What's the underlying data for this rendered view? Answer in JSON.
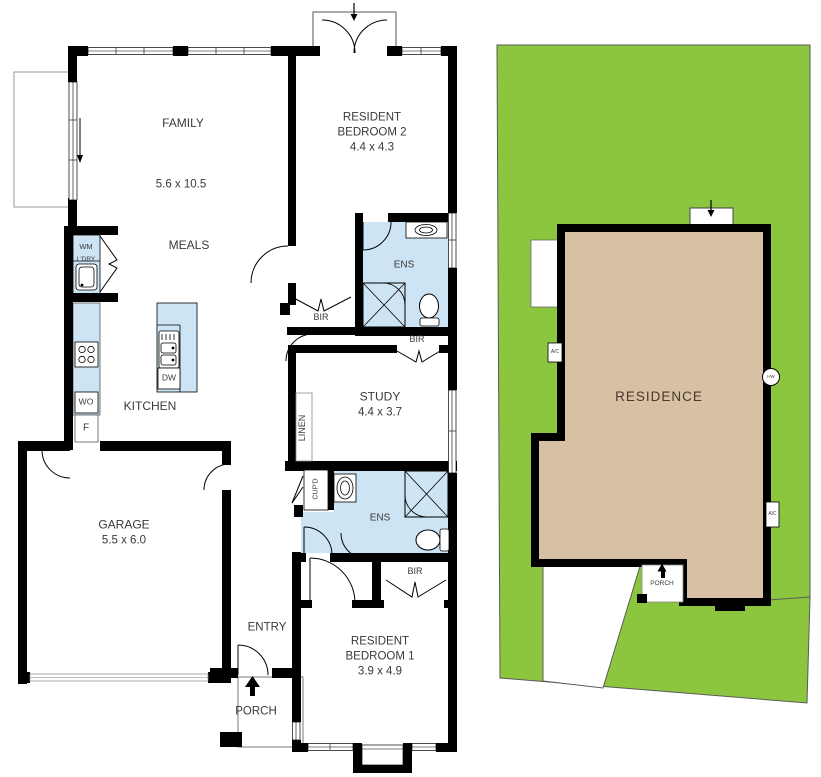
{
  "colors": {
    "grass": "#8CC63F",
    "residence_fill": "#D8C0A4",
    "wet_area": "#CDE4F5",
    "wall": "#000000"
  },
  "floorplan": {
    "family": {
      "name": "FAMILY",
      "dim": "5.6 x 10.5"
    },
    "meals": {
      "name": "MEALS"
    },
    "kitchen": {
      "name": "KITCHEN"
    },
    "garage": {
      "name": "GARAGE",
      "dim": "5.5 x 6.0"
    },
    "entry": {
      "name": "ENTRY"
    },
    "porch": {
      "name": "PORCH"
    },
    "study": {
      "name": "STUDY",
      "dim": "4.4 x 3.7"
    },
    "bedroom2": {
      "name_line1": "RESIDENT",
      "name_line2": "BEDROOM 2",
      "dim": "4.4 x 4.3"
    },
    "bedroom1": {
      "name_line1": "RESIDENT",
      "name_line2": "BEDROOM 1",
      "dim": "3.9 x 4.9"
    },
    "ensuite_upper": {
      "name": "ENS"
    },
    "ensuite_lower": {
      "name": "ENS"
    },
    "robe_bedroom2": {
      "name": "BIR"
    },
    "robe_study": {
      "name": "BIR"
    },
    "robe_bedroom1": {
      "name": "BIR"
    },
    "linen": {
      "name": "LINEN"
    },
    "cupboard": {
      "name": "CUP'D"
    },
    "laundry": {
      "wm": "WM",
      "name": "L'DRY"
    },
    "appliances": {
      "wall_oven": "WO",
      "fridge": "F",
      "dishwasher": "DW"
    }
  },
  "siteplan": {
    "residence": {
      "name": "RESIDENCE"
    },
    "porch": {
      "name": "PORCH"
    },
    "ac_left": {
      "name": "A/C"
    },
    "ac_right": {
      "name": "A/C"
    },
    "hot_water": {
      "name": "HW"
    }
  },
  "icons": {
    "porch_entry": "arrow-up",
    "bedroom2_entry": "arrow-down",
    "family_slider": "arrow-down",
    "site_entry": "arrow-down",
    "site_porch": "arrow-up"
  }
}
